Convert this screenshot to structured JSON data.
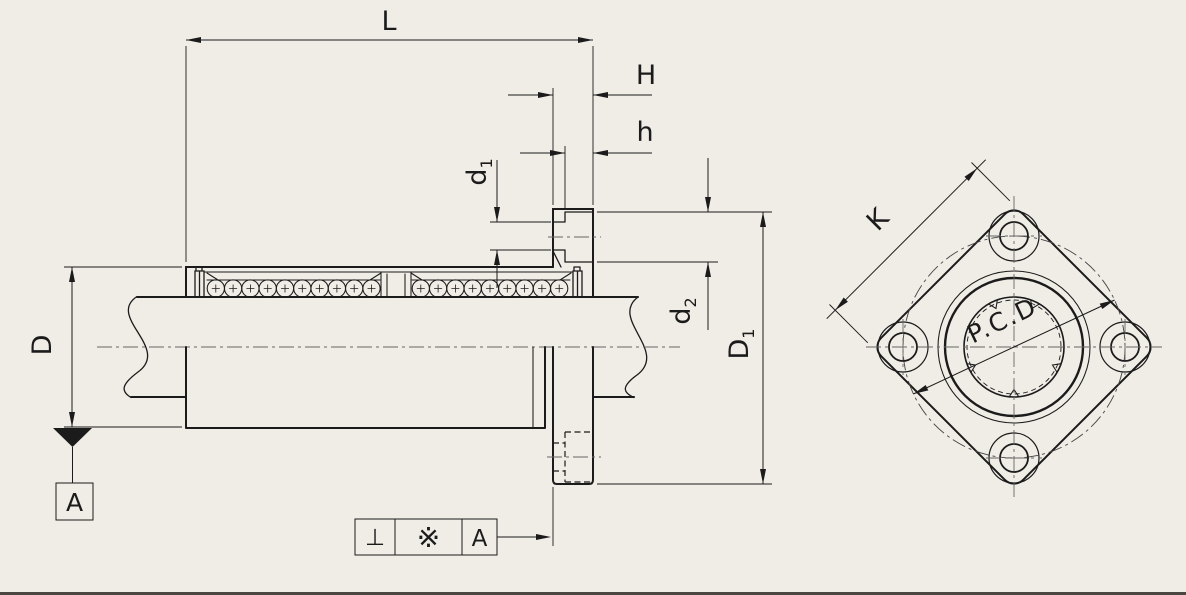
{
  "labels": {
    "L": "L",
    "H": "H",
    "h": "h",
    "D": "D",
    "K": "K",
    "d1": {
      "base": "d",
      "sub": "1"
    },
    "d2": {
      "base": "d",
      "sub": "2"
    },
    "D1": {
      "base": "D",
      "sub": "1"
    },
    "pcd": "P.C.D"
  },
  "datum": {
    "label": "A"
  },
  "fcf": {
    "perpendicularity": "⊥",
    "reference_mark": "※",
    "datum_ref": "A"
  },
  "colors": {
    "background": "#f0ece6",
    "line": "#1b1b1b",
    "centerline": "#666666"
  }
}
